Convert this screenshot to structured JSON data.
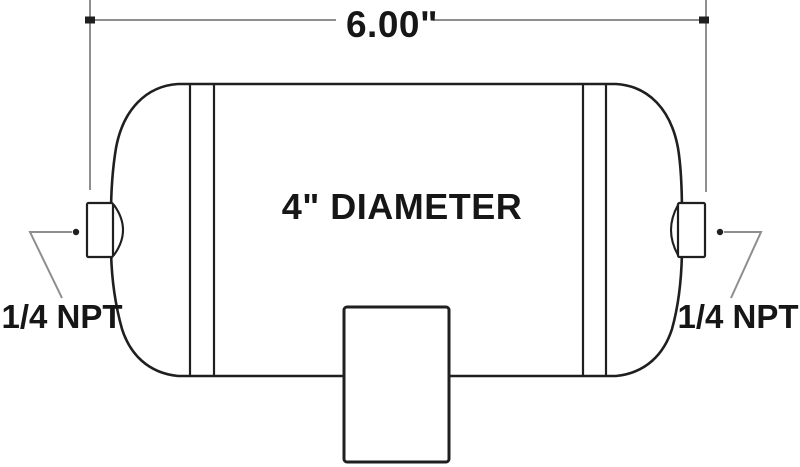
{
  "labels": {
    "length_dimension": "6.00\"",
    "diameter": "4\" DIAMETER",
    "left_port": "1/4 NPT",
    "right_port": "1/4 NPT"
  },
  "colors": {
    "outline": "#1f1f1f",
    "annotation": "#8e8e8e",
    "text": "#161616",
    "background": "#ffffff"
  }
}
